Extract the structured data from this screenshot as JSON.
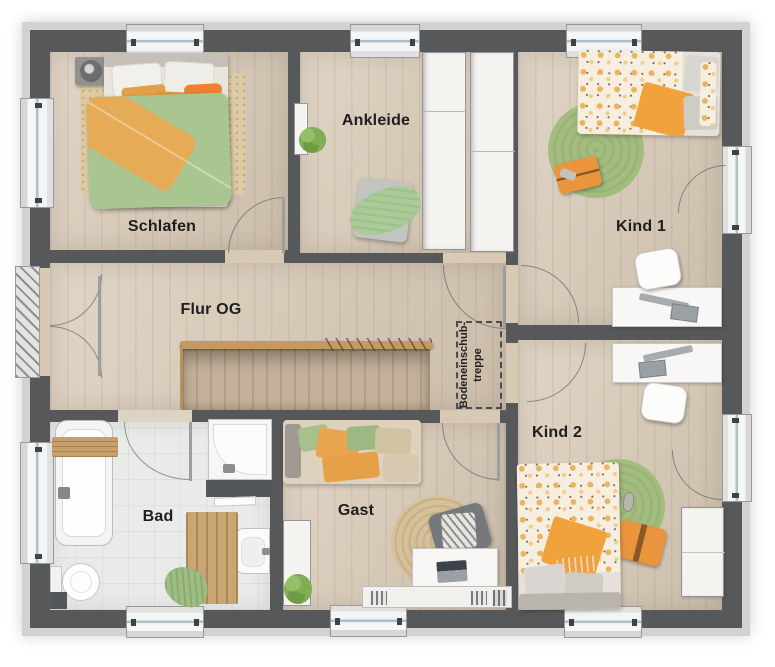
{
  "plan": {
    "rooms": {
      "schlafen": "Schlafen",
      "ankleide": "Ankleide",
      "kind1": "Kind 1",
      "kind2": "Kind 2",
      "flur": "Flur OG",
      "bad": "Bad",
      "gast": "Gast"
    },
    "attic_hatch": {
      "line1": "Bodeneinschub-",
      "line2": "treppe"
    },
    "colors": {
      "wall": "#57585a",
      "outer_band": "#d2d2d2",
      "wood_floor": "#d8c9b5",
      "tile_floor": "#e9ebe9",
      "duvet_green": "#aac690",
      "accent_orange": "#e8a74f",
      "bright_orange": "#f08030",
      "rug_green": "#a3bd7e",
      "rug_jute": "#d6c099",
      "rail_wood": "#c49a63",
      "window_glass": "#aebfc7"
    }
  }
}
